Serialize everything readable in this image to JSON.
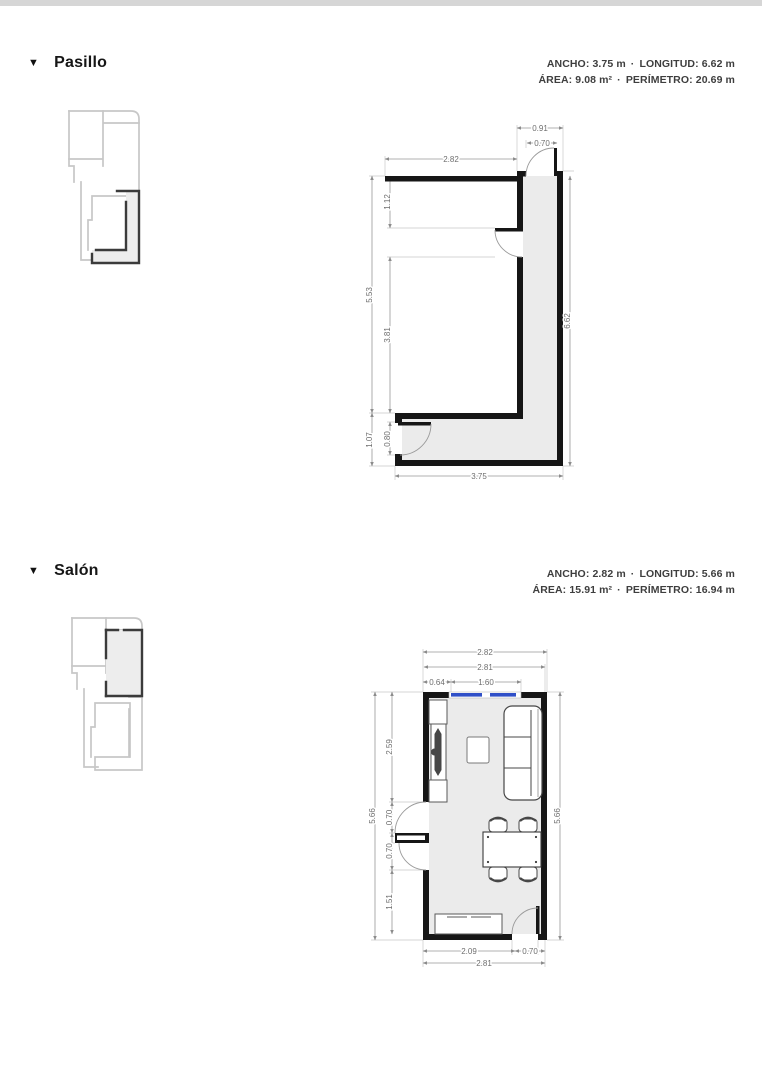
{
  "sections": [
    {
      "id": "pasillo",
      "collapse_icon": "▼",
      "title": "Pasillo",
      "stats": {
        "ancho_label": "ANCHO:",
        "ancho_value": "3.75 m",
        "longitud_label": "LONGITUD:",
        "longitud_value": "6.62 m",
        "area_label": "ÁREA:",
        "area_value": "9.08 m²",
        "perimetro_label": "PERÍMETRO:",
        "perimetro_value": "20.69 m",
        "separator": "·"
      },
      "dims": {
        "corridor_outer_width": "0.91",
        "top_door_width": "0.70",
        "top_width": "2.82",
        "left_total": "5.53",
        "left_upper": "1.12",
        "left_lower": "3.81",
        "bottom_left_height": "1.07",
        "bottom_left_door": "0.80",
        "right_total": "6.62",
        "bottom_width": "3.75"
      }
    },
    {
      "id": "salon",
      "collapse_icon": "▼",
      "title": "Salón",
      "stats": {
        "ancho_label": "ANCHO:",
        "ancho_value": "2.82 m",
        "longitud_label": "LONGITUD:",
        "longitud_value": "5.66 m",
        "area_label": "ÁREA:",
        "area_value": "15.91 m²",
        "perimetro_label": "PERÍMETRO:",
        "perimetro_value": "16.94 m",
        "separator": "·"
      },
      "dims": {
        "top_outer": "2.82",
        "top_inner": "2.81",
        "window_offset": "0.64",
        "window_width": "1.60",
        "left_total": "5.66",
        "left_upper": "2.59",
        "left_door1": "0.70",
        "left_door2": "0.70",
        "left_lower": "1.51",
        "right_total": "5.66",
        "bottom_left": "2.09",
        "bottom_door": "0.70",
        "bottom_total": "2.81"
      }
    }
  ]
}
